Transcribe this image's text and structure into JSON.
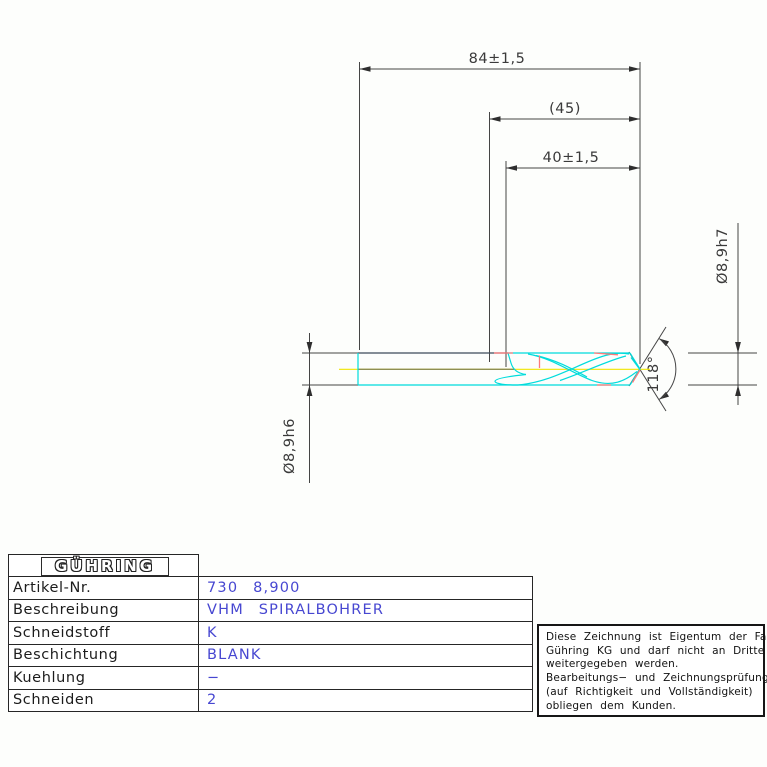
{
  "drawing": {
    "dimensions": {
      "overall_length": "84±1,5",
      "step_length_ref": "(45)",
      "flute_length": "40±1,5",
      "front_diameter": "Ø8,9h7",
      "shank_diameter": "Ø8,9h6",
      "point_angle": "118°"
    },
    "colors": {
      "outline_cyan": "#00dcdc",
      "centerline_yellow": "#f0e400",
      "centerline_olive": "#8f8f52",
      "highlight_red": "#ff7a7a",
      "shank_top_dark": "#3c4a58",
      "dimension_gray": "#454545"
    }
  },
  "title_block": {
    "logo_text": "GÜHRING",
    "rows": [
      {
        "label": "Artikel-Nr.",
        "value": "730 8,900"
      },
      {
        "label": "Beschreibung",
        "value": "VHM SPIRALBOHRER"
      },
      {
        "label": "Schneidstoff",
        "value": "K"
      },
      {
        "label": "Beschichtung",
        "value": "BLANK"
      },
      {
        "label": "Kuehlung",
        "value": "−"
      },
      {
        "label": "Schneiden",
        "value": "2"
      }
    ]
  },
  "disclaimer": {
    "lines": [
      "Diese Zeichnung ist Eigentum der Fa.",
      "Gühring KG und darf nicht an Dritte",
      "weitergegeben werden.",
      "Bearbeitungs− und Zeichnungsprüfung",
      "(auf Richtigkeit und Vollständigkeit)",
      "obliegen dem Kunden."
    ]
  }
}
